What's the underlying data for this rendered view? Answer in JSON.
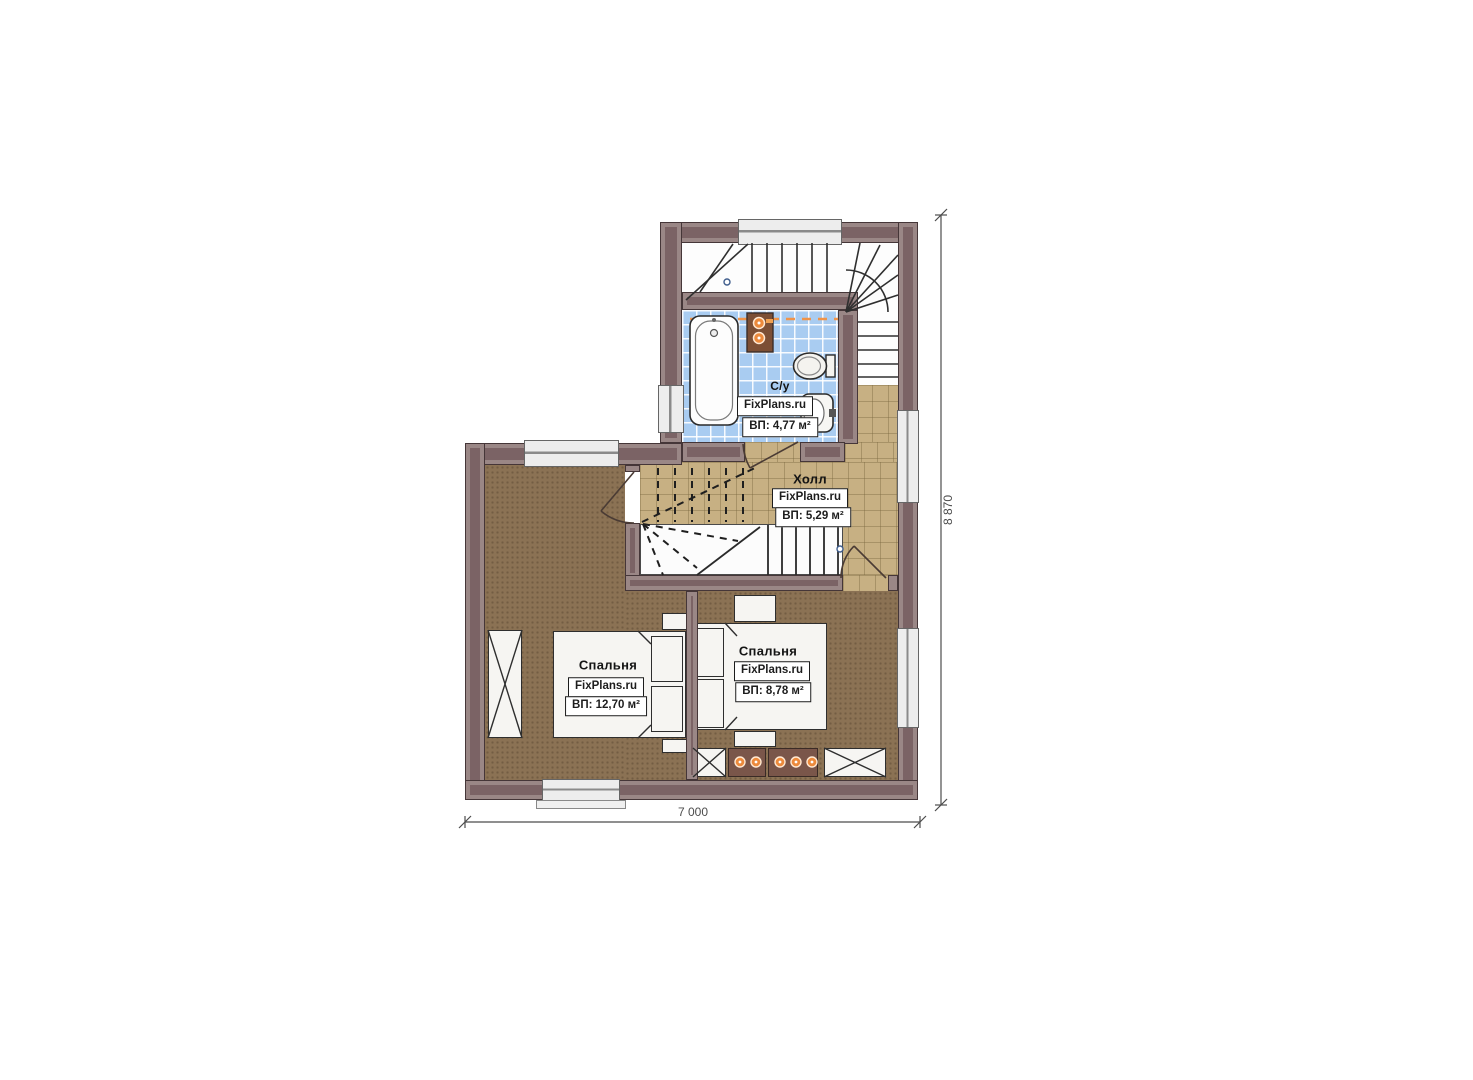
{
  "plan": {
    "type": "floor-plan",
    "watermark": "FixPlans.ru"
  },
  "rooms": {
    "bathroom": {
      "name": "С/у",
      "brand": "FixPlans.ru",
      "area": "ВП: 4,77 м²"
    },
    "hall": {
      "name": "Холл",
      "brand": "FixPlans.ru",
      "area": "ВП: 5,29 м²"
    },
    "bedroom_left": {
      "name": "Спальня",
      "brand": "FixPlans.ru",
      "area": "ВП: 12,70 м²"
    },
    "bedroom_right": {
      "name": "Спальня",
      "brand": "FixPlans.ru",
      "area": "ВП: 8,78 м²"
    }
  },
  "dimensions": {
    "width_label": "7 000",
    "height_label": "8 870"
  },
  "objects": [
    "staircase-upper",
    "staircase-middle",
    "bathtub",
    "toilet",
    "sink",
    "water-heater",
    "double-bed",
    "single-bed",
    "wardrobe",
    "dresser",
    "bedside-table",
    "window",
    "door"
  ],
  "colors": {
    "wall": "#7b6365",
    "bathroom_tile": "#a9ccf1",
    "hall_tile": "#c7b083",
    "bedroom_floor": "#8b7254",
    "accent_orange": "#ec8a3c",
    "dimension_line": "#4c4c4c"
  }
}
